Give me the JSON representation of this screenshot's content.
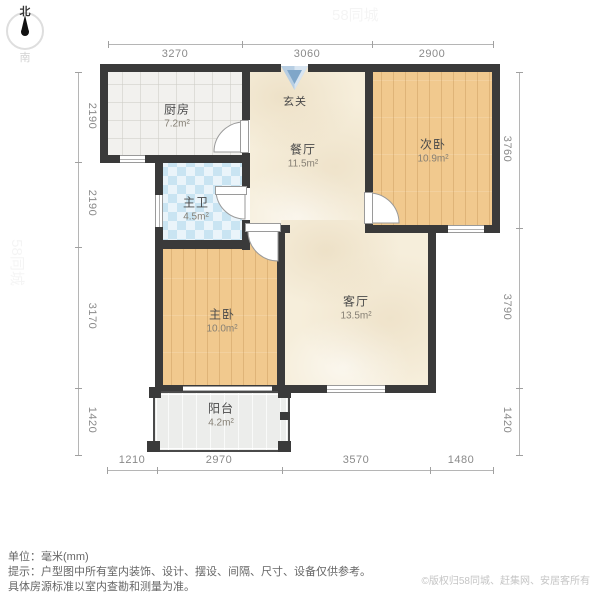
{
  "compass": {
    "north": "北",
    "south": "南"
  },
  "dims": {
    "top": [
      "3270",
      "3060",
      "2900"
    ],
    "bottom": [
      "1210",
      "2970",
      "3570",
      "1480"
    ],
    "left": [
      "2190",
      "2190",
      "3170",
      "1420"
    ],
    "right": [
      "3760",
      "3790",
      "1420"
    ]
  },
  "rooms": {
    "kitchen": {
      "name": "厨房",
      "area": "7.2m²"
    },
    "entry": {
      "name": "玄关"
    },
    "dining": {
      "name": "餐厅",
      "area": "11.5m²"
    },
    "bedroom2": {
      "name": "次卧",
      "area": "10.9m²"
    },
    "bathroom": {
      "name": "主卫",
      "area": "4.5m²"
    },
    "bedroom1": {
      "name": "主卧",
      "area": "10.0m²"
    },
    "living": {
      "name": "客厅",
      "area": "13.5m²"
    },
    "balcony": {
      "name": "阳台",
      "area": "4.2m²"
    }
  },
  "footer": {
    "unit": "单位：毫米(mm)",
    "tip1": "提示：户型图中所有室内装饰、设计、摆设、间隔、尺寸、设备仅供参考。",
    "tip2": "具体房源标准以室内查勘和测量为准。",
    "copyright": "©版权归58同城、赶集网、安居客所有"
  },
  "watermark": "58同城",
  "colors": {
    "wall": "#3a3a3a",
    "wood_floor": "#f1c98e",
    "tile_blue": "#c9e4f2",
    "beige_floor": "#f6eedb",
    "entry_arrow": "#8fb3d4"
  }
}
